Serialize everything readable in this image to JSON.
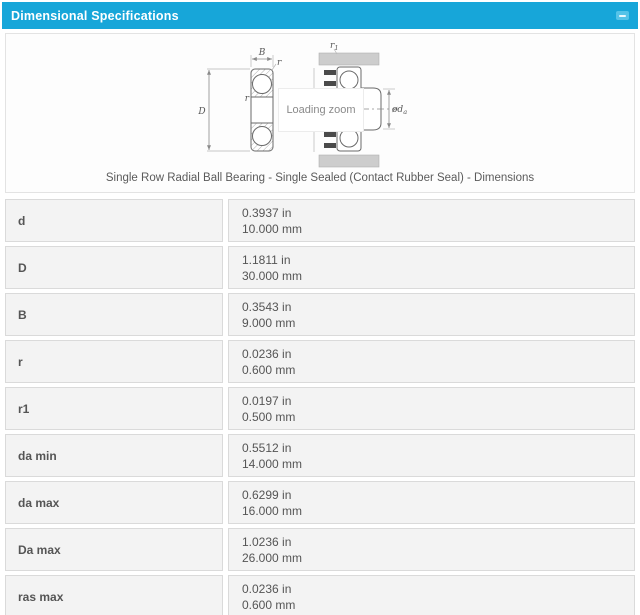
{
  "panel": {
    "title": "Dimensional Specifications",
    "collapse_icon": "minus"
  },
  "figure": {
    "loading_text": "Loading zoom",
    "caption": "Single Row Radial Ball Bearing - Single Sealed (Contact Rubber Seal) - Dimensions",
    "labels": {
      "B": "B",
      "r_corner": "r",
      "r_inner": "r",
      "D": "D",
      "r1_main": "r",
      "r1_sub": "1",
      "da_main": "ød",
      "da_sub": "a"
    }
  },
  "colors": {
    "header_bg": "#17a6d9",
    "header_text": "#ffffff",
    "cell_bg": "#f3f3f3",
    "cell_border": "#dadada",
    "body_text": "#555555"
  },
  "table": {
    "rows": [
      {
        "label": "d",
        "inch": "0.3937 in",
        "mm": "10.000 mm"
      },
      {
        "label": "D",
        "inch": "1.1811 in",
        "mm": "30.000 mm"
      },
      {
        "label": "B",
        "inch": "0.3543 in",
        "mm": "9.000 mm"
      },
      {
        "label": "r",
        "inch": "0.0236 in",
        "mm": "0.600 mm"
      },
      {
        "label": "r1",
        "inch": "0.0197 in",
        "mm": "0.500 mm"
      },
      {
        "label": "da min",
        "inch": "0.5512 in",
        "mm": "14.000 mm"
      },
      {
        "label": "da max",
        "inch": "0.6299 in",
        "mm": "16.000 mm"
      },
      {
        "label": "Da max",
        "inch": "1.0236 in",
        "mm": "26.000 mm"
      },
      {
        "label": "ras max",
        "inch": "0.0236 in",
        "mm": "0.600 mm"
      }
    ]
  }
}
